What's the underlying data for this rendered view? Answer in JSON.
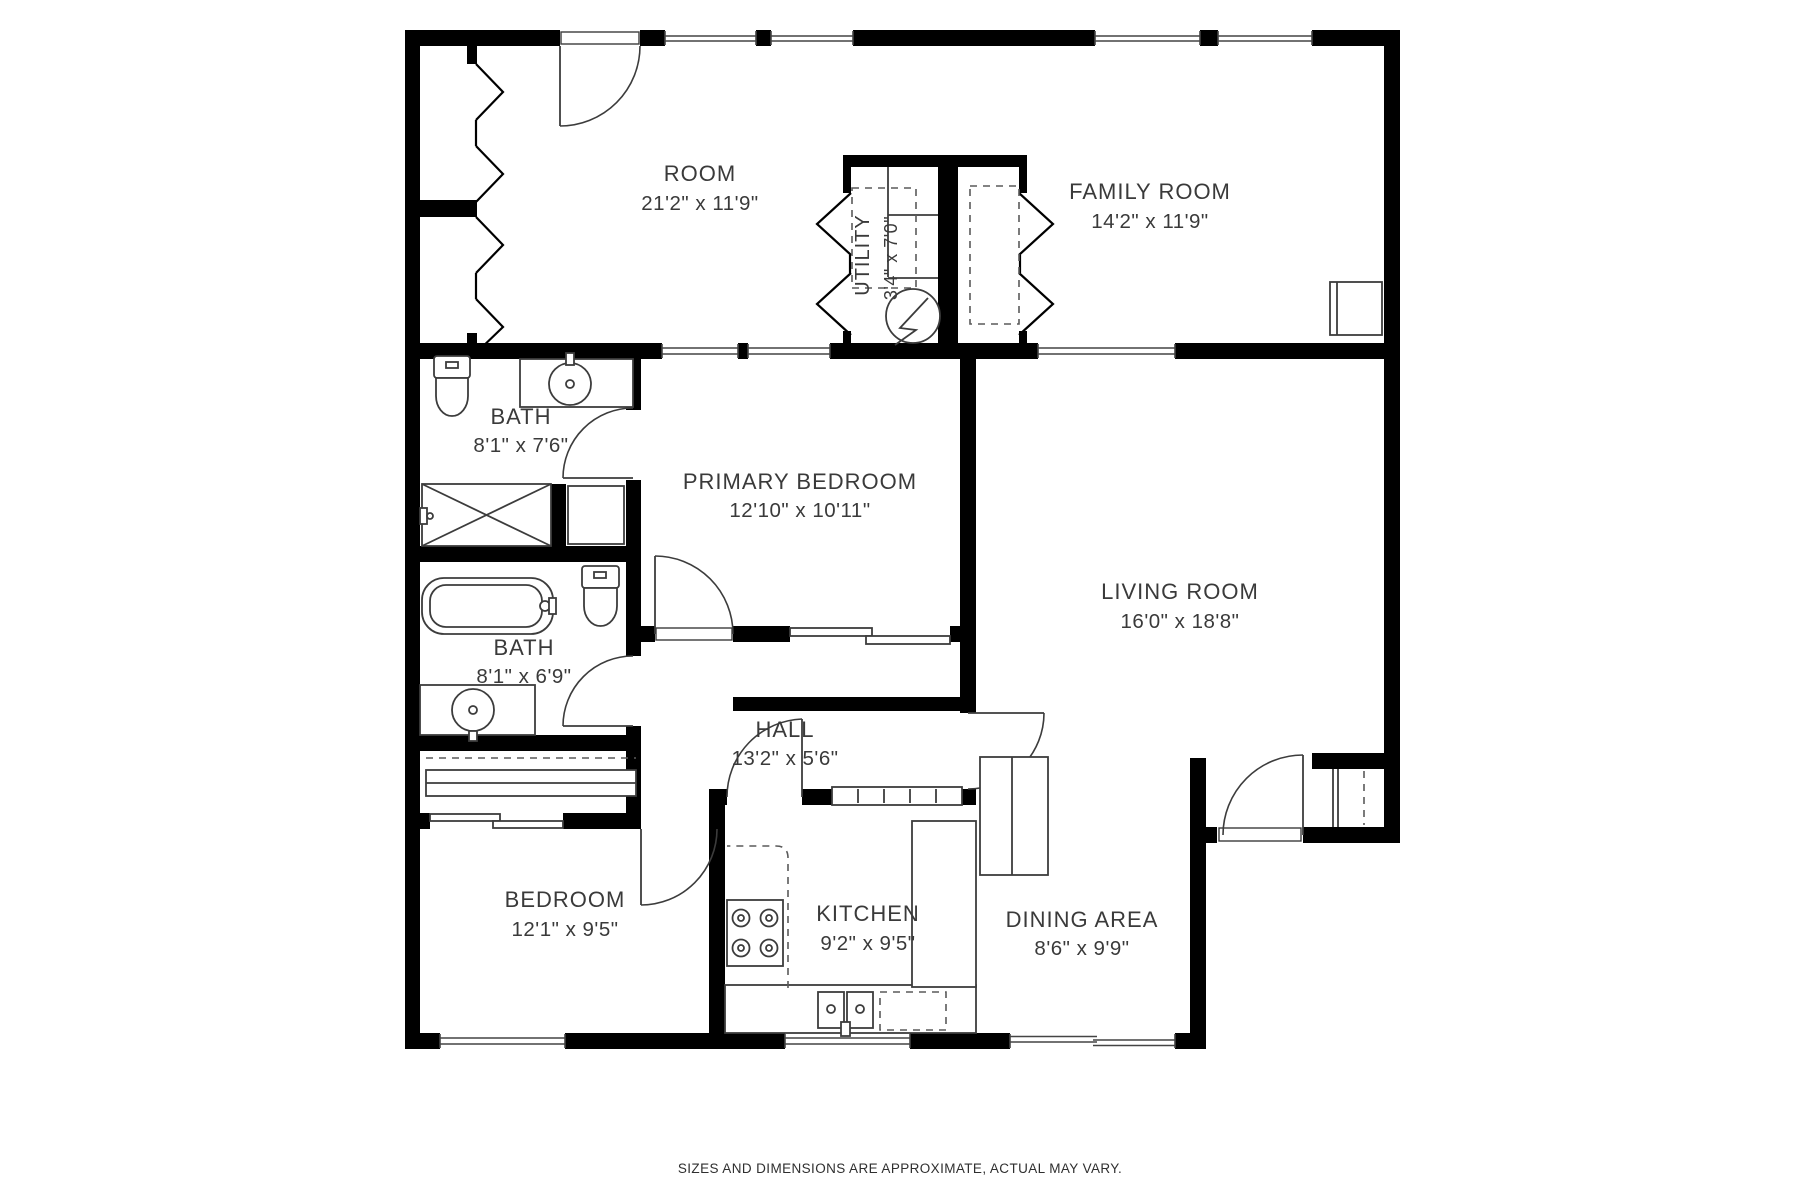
{
  "rooms": {
    "room": {
      "name": "ROOM",
      "dims": "21'2\" x 11'9\""
    },
    "utility": {
      "name": "UTILITY",
      "dims": "3'4\" x 7'0\""
    },
    "family_room": {
      "name": "FAMILY ROOM",
      "dims": "14'2\" x 11'9\""
    },
    "bath_upper": {
      "name": "BATH",
      "dims": "8'1\" x 7'6\""
    },
    "primary_bedroom": {
      "name": "PRIMARY BEDROOM",
      "dims": "12'10\" x 10'11\""
    },
    "living_room": {
      "name": "LIVING ROOM",
      "dims": "16'0\" x 18'8\""
    },
    "bath_lower": {
      "name": "BATH",
      "dims": "8'1\" x 6'9\""
    },
    "hall": {
      "name": "HALL",
      "dims": "13'2\" x 5'6\""
    },
    "bedroom": {
      "name": "BEDROOM",
      "dims": "12'1\" x 9'5\""
    },
    "kitchen": {
      "name": "KITCHEN",
      "dims": "9'2\" x 9'5\""
    },
    "dining_area": {
      "name": "DINING AREA",
      "dims": "8'6\" x 9'9\""
    }
  },
  "footer": {
    "disclaimer": "SIZES AND DIMENSIONS ARE APPROXIMATE, ACTUAL MAY VARY."
  },
  "colors": {
    "wall": "#000000",
    "line": "#3c3c3c",
    "text": "#3a3a3a",
    "background": "#ffffff"
  }
}
